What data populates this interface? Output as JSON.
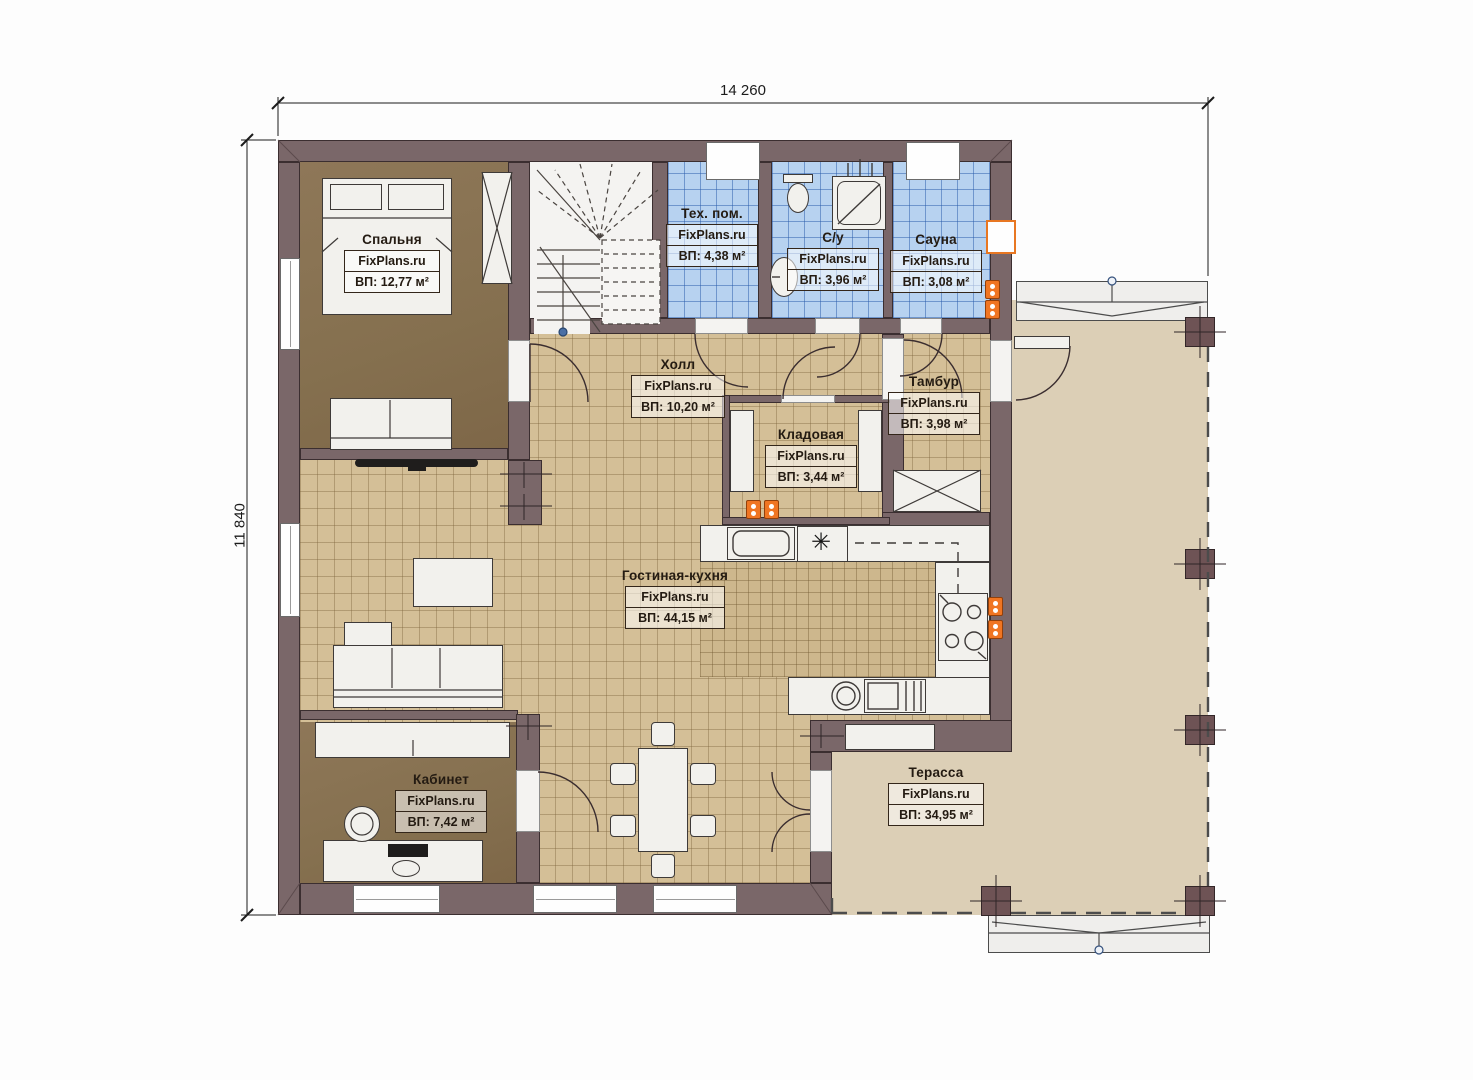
{
  "title": "План первого этажа",
  "dimensions": {
    "width_label": "14 260",
    "height_label": "11 840"
  },
  "rooms": [
    {
      "id": "bedroom",
      "name": "Спальня",
      "brand": "FixPlans.ru",
      "area": "ВП: 12,77 м²"
    },
    {
      "id": "tech",
      "name": "Тех. пом.",
      "brand": "FixPlans.ru",
      "area": "ВП: 4,38 м²"
    },
    {
      "id": "bathroom",
      "name": "С/у",
      "brand": "FixPlans.ru",
      "area": "ВП: 3,96 м²"
    },
    {
      "id": "sauna",
      "name": "Сауна",
      "brand": "FixPlans.ru",
      "area": "ВП: 3,08 м²"
    },
    {
      "id": "hall",
      "name": "Холл",
      "brand": "FixPlans.ru",
      "area": "ВП: 10,20 м²"
    },
    {
      "id": "tambour",
      "name": "Тамбур",
      "brand": "FixPlans.ru",
      "area": "ВП: 3,98 м²"
    },
    {
      "id": "pantry",
      "name": "Кладовая",
      "brand": "FixPlans.ru",
      "area": "ВП: 3,44 м²"
    },
    {
      "id": "living",
      "name": "Гостиная-кухня",
      "brand": "FixPlans.ru",
      "area": "ВП: 44,15 м²"
    },
    {
      "id": "office",
      "name": "Кабинет",
      "brand": "FixPlans.ru",
      "area": "ВП: 7,42 м²"
    },
    {
      "id": "terrace",
      "name": "Терасса",
      "brand": "FixPlans.ru",
      "area": "ВП: 34,95 м²"
    }
  ],
  "icons": {
    "fridge_snowflake": "✳"
  },
  "colors": {
    "wall": "#7a6769",
    "tile": "#d4bf97",
    "tile_small": "#cdb78d",
    "tile_blue": "#b7d2f0",
    "wood": "#8a7254",
    "terrace": "#dccfb6",
    "accent_orange": "#f07522"
  }
}
